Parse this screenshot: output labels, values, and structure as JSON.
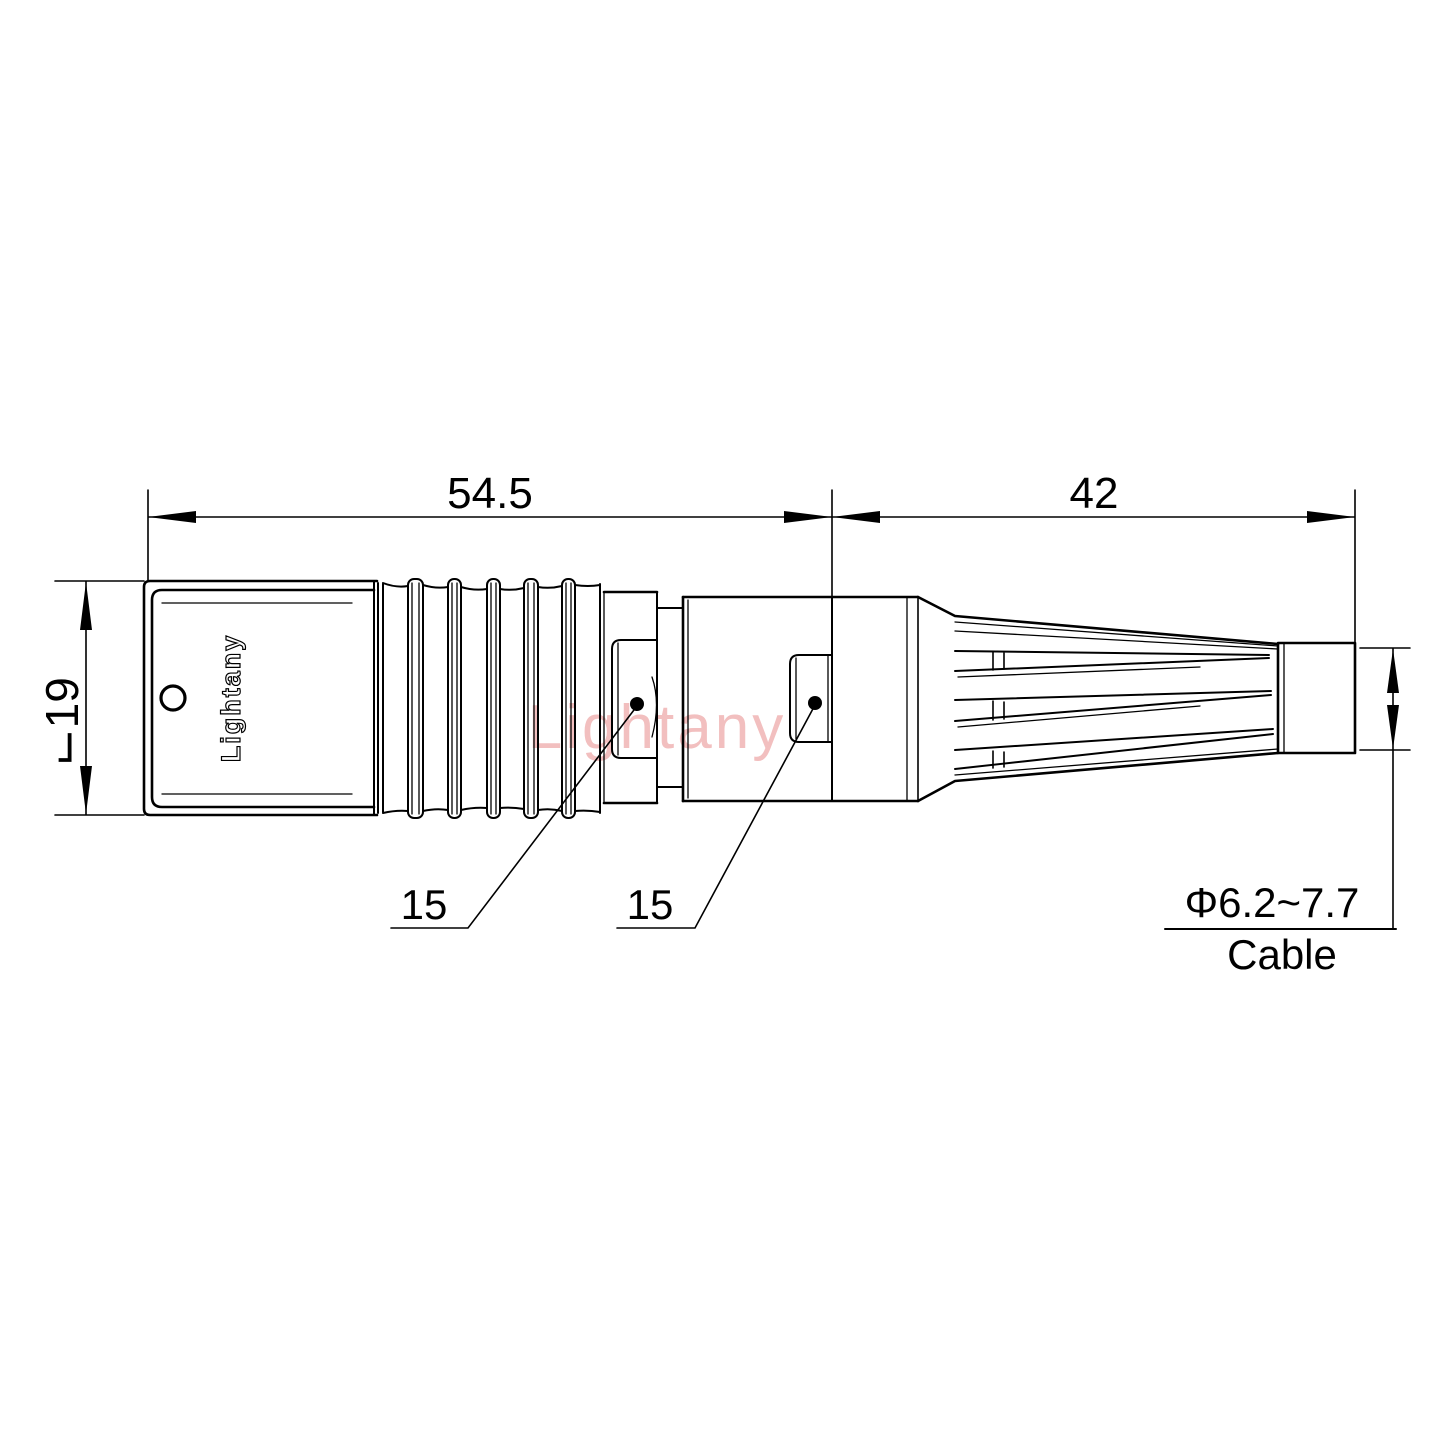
{
  "dimensions": {
    "front_assembly_length": "54.5",
    "rear_assembly_length": "42",
    "body_diameter": "⌙19",
    "front_nut_size": "15",
    "rear_nut_size": "15",
    "cable_range": "Φ6.2~7.7",
    "cable_caption": "Cable"
  },
  "branding": {
    "body_engraving": "Lightany",
    "watermark": "Lightany"
  },
  "colors": {
    "line": "#000000",
    "watermark": "#f2bfbf",
    "background": "#ffffff"
  }
}
